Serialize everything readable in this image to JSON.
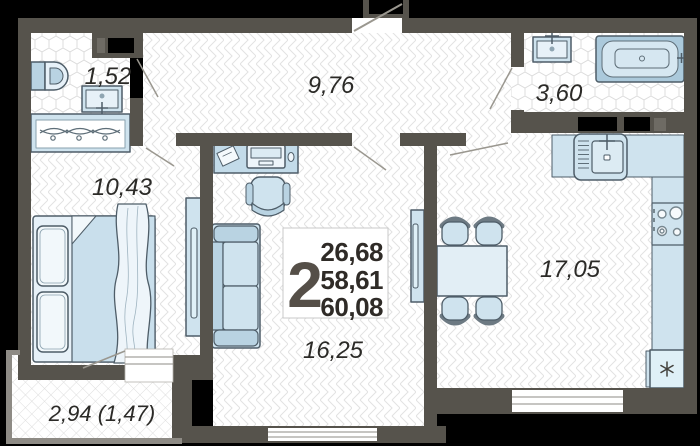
{
  "plan": {
    "type": "apartment-floor-plan",
    "badge": {
      "rooms_count": "2",
      "area_living": "26,68",
      "area_apartment": "58,61",
      "area_total": "60,08"
    },
    "rooms": {
      "wc": {
        "area": "1,52"
      },
      "hallway": {
        "area": "9,76"
      },
      "bathroom": {
        "area": "3,60"
      },
      "bedroom": {
        "area": "10,43"
      },
      "living_room": {
        "area": "16,25"
      },
      "kitchen": {
        "area": "17,05"
      },
      "balcony": {
        "area": "2,94 (1,47)"
      }
    },
    "icons": {
      "toilet": "toilet-top-view",
      "washbasin": "sink-with-faucet",
      "wardrobe": "closet-with-hangers",
      "bed": "double-bed-with-pillows",
      "tv_dresser": "dresser-with-tv",
      "desk": "desk-with-laptop",
      "office_chair": "office-chair",
      "sofa": "two-seat-sofa",
      "tv_unit": "tv-stand",
      "dining_set": "table-with-four-chairs",
      "kitchen_sink": "kitchen-sink-with-rack",
      "stove": "four-burner-stove",
      "fridge": "fridge-snowflake-asterisk",
      "bathtub": "bathtub-top-view"
    },
    "colors": {
      "background": "#000000",
      "wall": "#56534c",
      "balcony_wall": "#8e8b85",
      "floor": "#ffffff",
      "pattern_line": "#e0e0e0",
      "furniture_fill": "#cfe3ee",
      "furniture_fill_alt": "#b9d3e2",
      "furniture_outline": "#4e5d68",
      "text": "#2b2a27"
    }
  }
}
